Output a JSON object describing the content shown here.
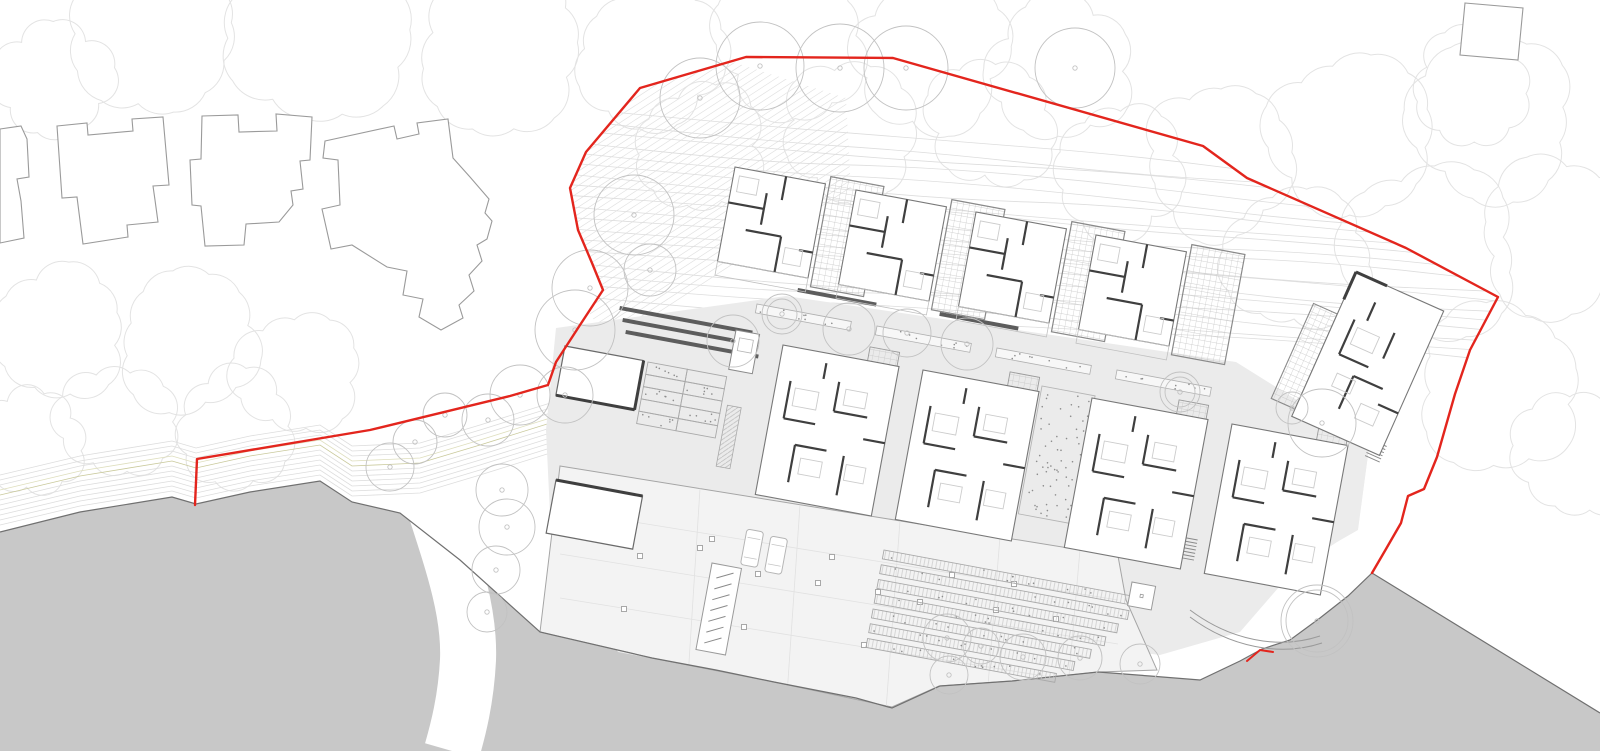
{
  "meta": {
    "width": 1600,
    "height": 751
  },
  "colors": {
    "background": "#ffffff",
    "boundary_red": "#e3251d",
    "landform_fill": "#c8c8c8",
    "landform_edge": "#707070",
    "plaza": "#ebebeb",
    "deck": "#f3f3f3",
    "court": "#ececec",
    "canopy": "#e3e3e3",
    "contour": "#dddddd",
    "hatch": "#e2e2e2",
    "khaki": "#c9c99b",
    "khaki2": "#dedebd",
    "tree": "#c2c2c2",
    "wall": "#3f3f3f",
    "outline": "#787878",
    "houseline": "#9a9a9a",
    "furniture": "#cccccc",
    "planter": "#a9a9a9",
    "speckle": "#8d8d8d",
    "column": "#9f9f9f",
    "bay": "#e1e1e1",
    "pathline": "#9a9a9a",
    "grid": "#c4c4c4"
  },
  "canopies": [
    [
      150,
      38,
      78
    ],
    [
      320,
      34,
      88
    ],
    [
      500,
      46,
      80
    ],
    [
      650,
      58,
      70
    ],
    [
      790,
      40,
      72
    ],
    [
      930,
      55,
      75
    ],
    [
      1060,
      70,
      70
    ],
    [
      55,
      80,
      55
    ],
    [
      1220,
      160,
      75
    ],
    [
      1350,
      138,
      80
    ],
    [
      1490,
      118,
      80
    ],
    [
      1560,
      238,
      78
    ],
    [
      1430,
      250,
      85
    ],
    [
      1300,
      258,
      70
    ],
    [
      1500,
      390,
      80
    ],
    [
      1580,
      455,
      60
    ],
    [
      1470,
      88,
      55
    ],
    [
      700,
      150,
      60
    ],
    [
      850,
      130,
      65
    ],
    [
      990,
      122,
      60
    ],
    [
      1120,
      172,
      62
    ],
    [
      60,
      330,
      65
    ],
    [
      190,
      340,
      70
    ],
    [
      300,
      372,
      60
    ],
    [
      120,
      420,
      55
    ],
    [
      240,
      430,
      55
    ],
    [
      35,
      442,
      48
    ]
  ],
  "existing_houses": [
    [
      [
        0,
        129
      ],
      [
        21,
        126
      ],
      [
        27,
        139
      ],
      [
        29,
        177
      ],
      [
        17,
        179
      ],
      [
        21,
        201
      ],
      [
        24,
        238
      ],
      [
        0,
        243
      ]
    ],
    [
      [
        57,
        126
      ],
      [
        87,
        123
      ],
      [
        88,
        135
      ],
      [
        133,
        131
      ],
      [
        132,
        119
      ],
      [
        163,
        117
      ],
      [
        169,
        185
      ],
      [
        153,
        186
      ],
      [
        155,
        200
      ],
      [
        158,
        222
      ],
      [
        127,
        225
      ],
      [
        128,
        237
      ],
      [
        83,
        244
      ],
      [
        77,
        197
      ],
      [
        62,
        198
      ]
    ],
    [
      [
        202,
        116
      ],
      [
        238,
        115
      ],
      [
        239,
        132
      ],
      [
        277,
        131
      ],
      [
        276,
        114
      ],
      [
        312,
        117
      ],
      [
        310,
        160
      ],
      [
        300,
        161
      ],
      [
        303,
        189
      ],
      [
        291,
        191
      ],
      [
        293,
        205
      ],
      [
        279,
        222
      ],
      [
        246,
        224
      ],
      [
        244,
        245
      ],
      [
        205,
        246
      ],
      [
        201,
        206
      ],
      [
        192,
        205
      ],
      [
        190,
        160
      ],
      [
        201,
        159
      ]
    ],
    [
      [
        325,
        141
      ],
      [
        394,
        126
      ],
      [
        397,
        139
      ],
      [
        419,
        134
      ],
      [
        417,
        123
      ],
      [
        448,
        119
      ],
      [
        453,
        158
      ],
      [
        470,
        177
      ],
      [
        489,
        199
      ],
      [
        485,
        213
      ],
      [
        492,
        221
      ],
      [
        487,
        239
      ],
      [
        477,
        245
      ],
      [
        482,
        261
      ],
      [
        469,
        275
      ],
      [
        474,
        291
      ],
      [
        459,
        305
      ],
      [
        463,
        318
      ],
      [
        441,
        330
      ],
      [
        419,
        317
      ],
      [
        423,
        299
      ],
      [
        403,
        295
      ],
      [
        407,
        271
      ],
      [
        387,
        267
      ],
      [
        352,
        245
      ],
      [
        331,
        249
      ],
      [
        322,
        209
      ],
      [
        340,
        205
      ],
      [
        338,
        160
      ],
      [
        323,
        158
      ]
    ]
  ],
  "square_building": [
    [
      1465,
      3
    ],
    [
      1523,
      8
    ],
    [
      1518,
      60
    ],
    [
      1460,
      55
    ]
  ],
  "boundary": [
    [
      195,
      505
    ],
    [
      197,
      459
    ],
    [
      370,
      430
    ],
    [
      510,
      396
    ],
    [
      548,
      385
    ],
    [
      556,
      362
    ],
    [
      580,
      325
    ],
    [
      603,
      290
    ],
    [
      592,
      263
    ],
    [
      578,
      230
    ],
    [
      570,
      188
    ],
    [
      586,
      152
    ],
    [
      640,
      88
    ],
    [
      746,
      57
    ],
    [
      893,
      58
    ],
    [
      1203,
      146
    ],
    [
      1247,
      178
    ],
    [
      1406,
      248
    ],
    [
      1498,
      297
    ],
    [
      1470,
      350
    ],
    [
      1455,
      394
    ],
    [
      1437,
      457
    ],
    [
      1424,
      489
    ],
    [
      1408,
      496
    ],
    [
      1401,
      523
    ],
    [
      1386,
      549
    ],
    [
      1372,
      573
    ]
  ],
  "boundary_closure": [
    [
      1240,
      660
    ],
    [
      1150,
      676
    ],
    [
      892,
      707
    ],
    [
      540,
      632
    ],
    [
      400,
      513
    ],
    [
      320,
      481
    ],
    [
      196,
      504
    ]
  ],
  "red_notch": [
    [
      1247,
      661
    ],
    [
      1260,
      650
    ],
    [
      1273,
      652
    ]
  ],
  "gray_mass": [
    [
      0,
      532
    ],
    [
      80,
      512
    ],
    [
      172,
      497
    ],
    [
      196,
      504
    ],
    [
      250,
      492
    ],
    [
      320,
      481
    ],
    [
      352,
      502
    ],
    [
      400,
      513
    ],
    [
      460,
      560
    ],
    [
      540,
      632
    ],
    [
      652,
      658
    ],
    [
      716,
      670
    ],
    [
      774,
      682
    ],
    [
      856,
      698
    ],
    [
      892,
      708
    ],
    [
      940,
      686
    ],
    [
      1012,
      681
    ],
    [
      1098,
      672
    ],
    [
      1150,
      676
    ],
    [
      1200,
      680
    ],
    [
      1240,
      661
    ],
    [
      1262,
      649
    ],
    [
      1290,
      640
    ],
    [
      1320,
      618
    ],
    [
      1348,
      596
    ],
    [
      1372,
      573
    ],
    [
      1600,
      713
    ],
    [
      1600,
      751
    ],
    [
      0,
      751
    ]
  ],
  "gray_edge_end": 26,
  "channel": {
    "d": "M430,492 C452,560 470,610 468,660 C466,700 458,730 452,751",
    "width": 56
  },
  "shore": {
    "base": [
      [
        0,
        530
      ],
      [
        80,
        511
      ],
      [
        172,
        496
      ],
      [
        196,
        503
      ],
      [
        250,
        491
      ],
      [
        320,
        480
      ],
      [
        352,
        501
      ],
      [
        420,
        498
      ],
      [
        480,
        480
      ],
      [
        560,
        455
      ],
      [
        650,
        443
      ]
    ],
    "count": 11,
    "spacing": 5,
    "khaki": [
      7,
      8
    ]
  },
  "contours": {
    "count": 18,
    "x0": 548,
    "y0": 106,
    "x1": 1508,
    "y1": 192,
    "dy0": 11,
    "dy1": 10,
    "segs": 5,
    "amp": 7
  },
  "wisps": {
    "count": 5,
    "x0": 900,
    "y0": 634,
    "x1": 1186,
    "y1": 604,
    "dy": 8,
    "amp": 2.5,
    "segs": 3
  },
  "hatch": {
    "count": 40,
    "step": 6,
    "base": [
      482,
      148
    ],
    "perp": [
      0.545,
      0.838
    ],
    "dir": [
      0.838,
      -0.545
    ],
    "len": 430,
    "region": [
      [
        556,
        92
      ],
      [
        720,
        58
      ],
      [
        846,
        98
      ],
      [
        852,
        210
      ],
      [
        700,
        340
      ],
      [
        612,
        424
      ],
      [
        556,
        400
      ],
      [
        540,
        300
      ]
    ]
  },
  "surfaces": {
    "plaza": [
      [
        556,
        328
      ],
      [
        786,
        296
      ],
      [
        1236,
        362
      ],
      [
        1316,
        412
      ],
      [
        1370,
        440
      ],
      [
        1358,
        528
      ],
      [
        1292,
        572
      ],
      [
        1240,
        632
      ],
      [
        1160,
        655
      ],
      [
        1080,
        645
      ],
      [
        1000,
        648
      ],
      [
        940,
        660
      ],
      [
        892,
        700
      ],
      [
        770,
        680
      ],
      [
        618,
        652
      ],
      [
        552,
        556
      ],
      [
        546,
        430
      ]
    ],
    "deck": [
      [
        560,
        466
      ],
      [
        1118,
        556
      ],
      [
        1126,
        600
      ],
      [
        1157,
        670
      ],
      [
        1098,
        672
      ],
      [
        1012,
        681
      ],
      [
        939,
        686
      ],
      [
        892,
        707
      ],
      [
        774,
        682
      ],
      [
        652,
        658
      ],
      [
        540,
        632
      ]
    ],
    "court": [
      [
        1256,
        428
      ],
      [
        1370,
        440
      ],
      [
        1358,
        530
      ],
      [
        1288,
        570
      ],
      [
        1240,
        560
      ],
      [
        1228,
        480
      ]
    ]
  },
  "deck_details": {
    "bays": [
      44,
      88,
      132
    ],
    "verticals": [
      700,
      800,
      900,
      1000,
      1080
    ],
    "columns": [
      [
        640,
        556
      ],
      [
        758,
        574
      ],
      [
        818,
        583
      ],
      [
        878,
        592
      ],
      [
        996,
        610
      ],
      [
        1056,
        619
      ],
      [
        624,
        609
      ],
      [
        744,
        627
      ],
      [
        864,
        645
      ],
      [
        592,
        521
      ],
      [
        712,
        539
      ],
      [
        832,
        557
      ],
      [
        952,
        575
      ],
      [
        1014,
        584
      ],
      [
        700,
        548
      ],
      [
        920,
        602
      ]
    ],
    "cars": [
      [
        747,
        529
      ],
      [
        771,
        536
      ]
    ],
    "car_size": [
      17,
      36
    ],
    "ramp": {
      "o": [
        712,
        563
      ],
      "w": 30,
      "h": 88,
      "ticks": 7
    },
    "rot": 10.5
  },
  "planting": {
    "terraces": {
      "o": [
        884,
        550
      ],
      "rot": 10.5,
      "lengths": [
        252,
        252,
        244,
        234,
        222,
        208,
        192
      ],
      "rowH": 9,
      "gap": 15
    },
    "garden": {
      "o": [
        648,
        362
      ],
      "rot": 10.5,
      "cols": 2,
      "rows": 5,
      "cw": 40,
      "ch": 12.5,
      "strip": [
        86,
        28,
        14,
        62
      ]
    },
    "bed": {
      "o": [
        1042,
        386
      ],
      "rot": 10.5,
      "w": 54,
      "h": 130
    },
    "strips": [
      [
        757,
        304
      ],
      [
        877,
        326
      ],
      [
        997,
        348
      ],
      [
        1117,
        370
      ]
    ],
    "strip_size": [
      96,
      9
    ],
    "benches": [
      [
        798,
        288,
        80
      ],
      [
        940,
        312,
        80
      ],
      [
        620,
        306,
        135
      ],
      [
        623,
        318,
        135
      ],
      [
        626,
        330,
        135
      ],
      [
        1158,
        418,
        34
      ],
      [
        1273,
        444,
        34
      ]
    ],
    "bench_rot": 10.5,
    "kiosk": {
      "o": [
        736,
        330
      ],
      "rot": 10.5,
      "w": 24,
      "h": 40
    },
    "hut": {
      "o": [
        1132,
        582
      ],
      "rot": 10.5,
      "w": 24,
      "h": 24
    },
    "stairs": [
      [
        1372,
        440,
        24,
        16,
        6
      ],
      [
        1176,
        536,
        10.5,
        22,
        7
      ]
    ]
  },
  "paths": {
    "curve1": "M1190,610 C1230,640 1278,650 1320,636",
    "curve2": "M1190,617 C1230,647 1280,657 1322,643"
  },
  "units": {
    "rot": 10.5,
    "upper": {
      "origins": [
        [
          735,
          167
        ],
        [
          856,
          190
        ],
        [
          976,
          212
        ],
        [
          1096,
          235
        ]
      ],
      "room": [
        0,
        0,
        92,
        96
      ],
      "terrace": [
        96,
        -8,
        54,
        112
      ],
      "porch": [
        0,
        96,
        92,
        14
      ],
      "walls": [
        [
          0,
          36,
          36,
          36
        ],
        [
          36,
          20,
          36,
          52
        ],
        [
          52,
          0,
          52,
          24
        ],
        [
          22,
          60,
          58,
          60
        ],
        [
          58,
          60,
          58,
          96
        ],
        [
          78,
          70,
          92,
          70
        ]
      ],
      "furn": [
        [
          6,
          8,
          20,
          16
        ],
        [
          64,
          70,
          18,
          16
        ]
      ]
    },
    "mid": {
      "origins": [
        [
          783,
          345
        ],
        [
          923,
          370
        ],
        [
          1092,
          398
        ],
        [
          1232,
          424
        ]
      ],
      "room": [
        0,
        0,
        118,
        152
      ],
      "court": [
        86,
        -14,
        30,
        26
      ],
      "walls": [
        [
          14,
          34,
          14,
          72
        ],
        [
          14,
          72,
          46,
          72
        ],
        [
          62,
          26,
          62,
          56
        ],
        [
          62,
          56,
          96,
          56
        ],
        [
          30,
          96,
          30,
          134
        ],
        [
          30,
          96,
          62,
          96
        ],
        [
          80,
          98,
          80,
          138
        ],
        [
          96,
          78,
          118,
          78
        ],
        [
          46,
          10,
          46,
          26
        ]
      ],
      "furn": [
        [
          20,
          40,
          24,
          18
        ],
        [
          70,
          32,
          22,
          16
        ],
        [
          38,
          108,
          22,
          16
        ],
        [
          84,
          106,
          20,
          16
        ]
      ]
    }
  },
  "right_building": {
    "o": [
      1356,
      272
    ],
    "rot": 24,
    "room": [
      0,
      0,
      96,
      158
    ],
    "grid": [
      -26,
      46,
      26,
      104
    ],
    "walls": [
      [
        18,
        44,
        18,
        82
      ],
      [
        18,
        82,
        50,
        82
      ],
      [
        40,
        96,
        40,
        132
      ],
      [
        40,
        96,
        72,
        96
      ],
      [
        60,
        40,
        60,
        68
      ],
      [
        74,
        112,
        96,
        112
      ],
      [
        30,
        20,
        30,
        40
      ]
    ],
    "furn": [
      [
        24,
        50,
        24,
        18
      ],
      [
        58,
        118,
        20,
        16
      ],
      [
        24,
        100,
        20,
        14
      ]
    ],
    "bars": [
      [
        0,
        0,
        34,
        0
      ],
      [
        0,
        0,
        0,
        30
      ]
    ]
  },
  "aux_buildings": [
    {
      "o": [
        565,
        346
      ],
      "rot": 10.5,
      "w": 80,
      "h": 50,
      "heavy": "rb"
    },
    {
      "o": [
        556,
        480
      ],
      "rot": 10.5,
      "w": 88,
      "h": 54,
      "heavy": "t"
    }
  ],
  "trees": [
    [
      700,
      98,
      40,
      0
    ],
    [
      760,
      66,
      44,
      0
    ],
    [
      840,
      68,
      44,
      0
    ],
    [
      906,
      68,
      42,
      0
    ],
    [
      1075,
      68,
      40,
      0
    ],
    [
      634,
      215,
      40,
      0
    ],
    [
      650,
      270,
      26,
      0
    ],
    [
      590,
      288,
      38,
      0
    ],
    [
      575,
      330,
      40,
      0
    ],
    [
      565,
      395,
      28,
      0
    ],
    [
      520,
      395,
      30,
      0
    ],
    [
      488,
      420,
      26,
      0
    ],
    [
      445,
      415,
      22,
      0
    ],
    [
      415,
      442,
      22,
      0
    ],
    [
      390,
      467,
      24,
      0
    ],
    [
      502,
      490,
      26,
      0
    ],
    [
      507,
      527,
      28,
      0
    ],
    [
      496,
      570,
      24,
      0
    ],
    [
      487,
      612,
      20,
      0
    ],
    [
      733,
      341,
      26,
      0
    ],
    [
      782,
      314,
      20,
      1
    ],
    [
      849,
      329,
      26,
      0
    ],
    [
      907,
      333,
      24,
      0
    ],
    [
      967,
      344,
      26,
      0
    ],
    [
      1180,
      392,
      20,
      1
    ],
    [
      1292,
      408,
      16,
      0
    ],
    [
      1322,
      423,
      34,
      0
    ],
    [
      1317,
      621,
      36,
      1
    ],
    [
      947,
      638,
      24,
      0
    ],
    [
      981,
      646,
      18,
      0
    ],
    [
      1023,
      657,
      23,
      0
    ],
    [
      949,
      675,
      19,
      0
    ],
    [
      1080,
      658,
      22,
      0
    ],
    [
      1140,
      664,
      20,
      0
    ]
  ]
}
